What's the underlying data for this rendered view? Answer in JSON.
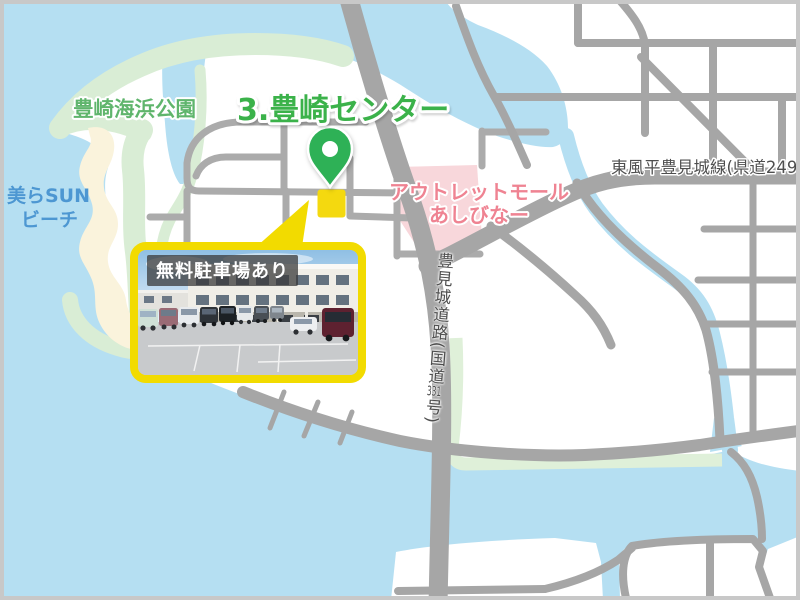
{
  "map": {
    "destination": {
      "title": "3.豊崎センター",
      "title_color": "#3BB24A"
    },
    "area_labels": {
      "park": {
        "text": "豊崎海浜公園",
        "color": "#5FB56C"
      },
      "beach": {
        "line1": "美らSUN",
        "line2": "ビーチ",
        "color": "#4D97D2"
      },
      "outlet_mall": {
        "line1": "アウトレットモール",
        "line2": "あしびなー",
        "color": "#EF8392",
        "area_color": "#F8D7DB"
      }
    },
    "road_labels": {
      "route249": {
        "text": "東風平豊見城線(県道249号)"
      },
      "route331": {
        "prefix": "豊見城道路(国道",
        "number": "331",
        "suffix": "号)"
      }
    },
    "marker": {
      "building_color": "#F4D90F",
      "pin_color": "#2EB156"
    },
    "photo": {
      "caption": "無料駐車場あり",
      "frame_color": "#F2DB00"
    },
    "colors": {
      "water": "#B5DFF2",
      "land": "#FFFFFF",
      "park_green": "#D9EDD5",
      "beach_sand": "#FAF3DC",
      "road_gray": "#A6A6A6",
      "route_strip_green": "#DFF0D9",
      "label_gray": "#4E4E4E",
      "border_gray": "#C8C8C8"
    }
  }
}
